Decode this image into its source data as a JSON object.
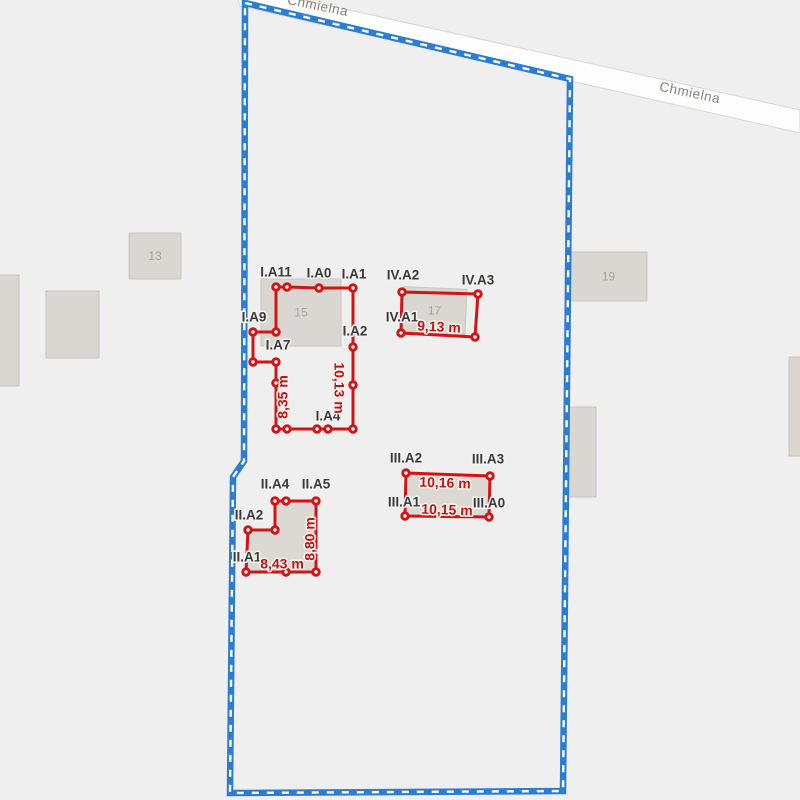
{
  "map": {
    "background_color": "#efefef",
    "building_fill": "#dad7d3",
    "building_stroke": "#c9c6c2",
    "measure_color": "#d21414",
    "measure_text_color": "#c41212",
    "vertex_label_color": "#3a3a3a",
    "street_label_color": "#8b8178",
    "building_number_color": "#a6a3a0",
    "road": {
      "band": {
        "points": [
          [
            232,
            -16
          ],
          [
            800,
            110
          ],
          [
            800,
            133
          ],
          [
            240,
            6
          ]
        ],
        "fill": "#fdfdfd",
        "border_color": "#d8d6d2"
      },
      "name_labels": [
        {
          "text": "Chmielna",
          "x": 317,
          "y": 10,
          "rotation": 11.5
        },
        {
          "text": "Chmielna",
          "x": 689,
          "y": 97,
          "rotation": 12
        }
      ]
    },
    "parcel_boundary": {
      "color": "#2b7dd1",
      "dash_color": "#ffffff",
      "points": [
        [
          245,
          3
        ],
        [
          570,
          79
        ],
        [
          563,
          791
        ],
        [
          230,
          793
        ],
        [
          233,
          477
        ],
        [
          244,
          461
        ]
      ]
    },
    "buildings": [
      {
        "label": "13",
        "x": 129,
        "y": 233,
        "w": 52,
        "h": 46,
        "rot": 0
      },
      {
        "label": "",
        "x": 46,
        "y": 291,
        "w": 53,
        "h": 67,
        "rot": 0
      },
      {
        "label": "",
        "x": -14,
        "y": 275,
        "w": 33,
        "h": 111,
        "rot": 0
      },
      {
        "label": "15",
        "x": 261,
        "y": 279,
        "w": 80,
        "h": 67,
        "rot": 0
      },
      {
        "label": "17",
        "x": 403,
        "y": 288,
        "w": 63,
        "h": 45,
        "rot": 2.5
      },
      {
        "label": "19",
        "x": 570,
        "y": 252,
        "w": 77,
        "h": 49,
        "rot": 0
      },
      {
        "label": "",
        "x": 567,
        "y": 407,
        "w": 29,
        "h": 90,
        "rot": 0
      },
      {
        "label": "",
        "x": 789,
        "y": 357,
        "w": 20,
        "h": 99,
        "rot": 0
      }
    ],
    "survey_polygons": [
      {
        "id": "I",
        "fill": "none",
        "points": [
          [
            276,
            287
          ],
          [
            287,
            287
          ],
          [
            319,
            288
          ],
          [
            353,
            288
          ],
          [
            353,
            347
          ],
          [
            353,
            385
          ],
          [
            353,
            429
          ],
          [
            328,
            429
          ],
          [
            317,
            429
          ],
          [
            287,
            429
          ],
          [
            276,
            429
          ],
          [
            276,
            383
          ],
          [
            276,
            362
          ],
          [
            253,
            362
          ],
          [
            253,
            332
          ],
          [
            276,
            332
          ]
        ],
        "vertex_labels": [
          {
            "text": "I.A11",
            "x": 276,
            "y": 272
          },
          {
            "text": "I.A0",
            "x": 319,
            "y": 273
          },
          {
            "text": "I.A1",
            "x": 354,
            "y": 274
          },
          {
            "text": "I.A2",
            "x": 355,
            "y": 331
          },
          {
            "text": "I.A4",
            "x": 328,
            "y": 416
          },
          {
            "text": "I.A7",
            "x": 278,
            "y": 345
          },
          {
            "text": "I.A9",
            "x": 254,
            "y": 317
          }
        ],
        "measurements": [
          {
            "text": "10,13 m",
            "x": 339,
            "y": 388,
            "rotation": 90
          },
          {
            "text": "8,35 m",
            "x": 283,
            "y": 397,
            "rotation": -90
          }
        ]
      },
      {
        "id": "II",
        "fill": "#dcd8d4",
        "points": [
          [
            275,
            501
          ],
          [
            286,
            501
          ],
          [
            316,
            501
          ],
          [
            316,
            572
          ],
          [
            286,
            572
          ],
          [
            246,
            572
          ],
          [
            248,
            530
          ],
          [
            275,
            530
          ]
        ],
        "vertex_labels": [
          {
            "text": "II.A4",
            "x": 275,
            "y": 484
          },
          {
            "text": "II.A5",
            "x": 316,
            "y": 484
          },
          {
            "text": "II.A2",
            "x": 249,
            "y": 515
          },
          {
            "text": "II.A1",
            "x": 247,
            "y": 557
          }
        ],
        "measurements": [
          {
            "text": "8,43 m",
            "x": 282,
            "y": 564,
            "rotation": 0
          },
          {
            "text": "8,80 m",
            "x": 310,
            "y": 539,
            "rotation": -90
          }
        ]
      },
      {
        "id": "III",
        "fill": "#dcd8d4",
        "points": [
          [
            406,
            473
          ],
          [
            490,
            476
          ],
          [
            489,
            517
          ],
          [
            405,
            516
          ]
        ],
        "vertex_labels": [
          {
            "text": "III.A2",
            "x": 406,
            "y": 458
          },
          {
            "text": "III.A3",
            "x": 488,
            "y": 459
          },
          {
            "text": "III.A1",
            "x": 404,
            "y": 502
          },
          {
            "text": "III.A0",
            "x": 489,
            "y": 503
          }
        ],
        "measurements": [
          {
            "text": "10,16 m",
            "x": 445,
            "y": 483,
            "rotation": 2
          },
          {
            "text": "10,15 m",
            "x": 447,
            "y": 510,
            "rotation": 2
          }
        ]
      },
      {
        "id": "IV",
        "fill": "none",
        "points": [
          [
            402,
            292
          ],
          [
            478,
            294
          ],
          [
            475,
            337
          ],
          [
            401,
            333
          ]
        ],
        "vertex_labels": [
          {
            "text": "IV.A2",
            "x": 403,
            "y": 275
          },
          {
            "text": "IV.A3",
            "x": 478,
            "y": 280
          },
          {
            "text": "IV.A1",
            "x": 402,
            "y": 317
          }
        ],
        "measurements": [
          {
            "text": "9,13 m",
            "x": 439,
            "y": 327,
            "rotation": 3
          }
        ]
      }
    ]
  }
}
